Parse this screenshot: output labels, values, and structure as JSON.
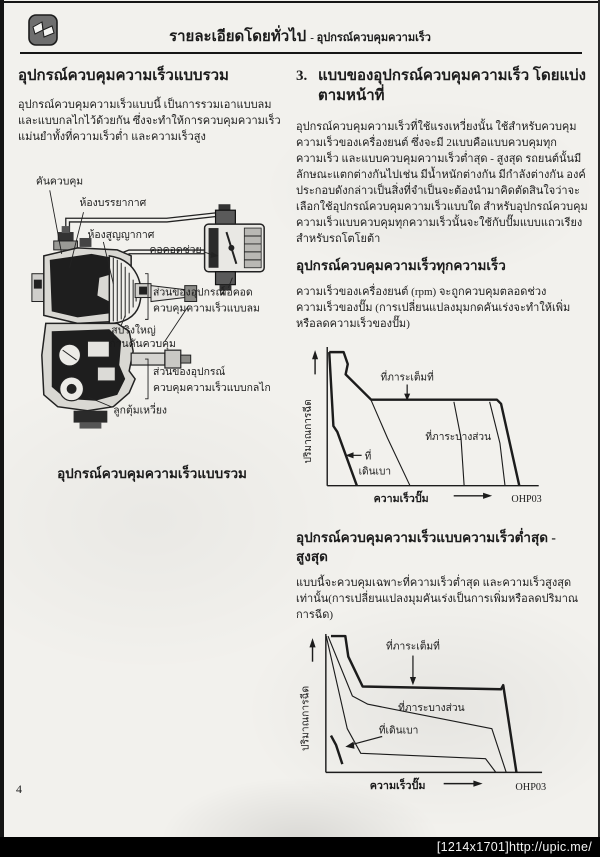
{
  "header": {
    "title_main": "รายละเอียดโดยทั่วไป",
    "title_sub": "- อุปกรณ์ควบคุมความเร็ว"
  },
  "left_column": {
    "heading": "อุปกรณ์ควบคุมความเร็วแบบรวม",
    "paragraph": "อุปกรณ์ควบคุมความเร็วแบบนี้ เป็นการรวมเอาแบบลม และแบบกลไกไว้ด้วยกัน ซึ่งจะทำให้การควบคุมความเร็วแม่นยำทั้งที่ความเร็วต่ำ และความเร็วสูง",
    "diagram": {
      "labels": {
        "control_lever": "คันควบคุม",
        "atmosphere_chamber": "ห้องบรรยากาศ",
        "vacuum_chamber": "ห้องสูญญากาศ",
        "aux_venturi": "คอคอดช่วย",
        "venturi": "คอคอด",
        "pneumatic_section_1": "ส่วนของอุปกรณ์",
        "pneumatic_section_2": "ควบคุมความเร็วแบบลม",
        "big_spring": "สปริงใหญ่",
        "control_rod": "ก้านคันควบคุม",
        "mechanical_section_1": "ส่วนของอุปกรณ์",
        "mechanical_section_2": "ควบคุมความเร็วแบบกลไก",
        "flyweight": "ลูกตุ้มเหวี่ยง"
      },
      "caption": "อุปกรณ์ควบคุมความเร็วแบบรวม"
    }
  },
  "right_column": {
    "section3_number": "3.",
    "section3_heading": "แบบของอุปกรณ์ควบคุมความเร็ว โดยแบ่งตามหน้าที่",
    "paragraph1": "อุปกรณ์ควบคุมความเร็วที่ใช้แรงเหวี่ยงนั้น ใช้สำหรับควบคุมความเร็วของเครื่องยนต์ ซึ่งจะมี 2แบบคือแบบควบคุมทุกความเร็ว และแบบควบคุมความเร็วต่ำสุด - สูงสุด รถยนต์นั้นมีลักษณะแตกต่างกันไปเช่น มีน้ำหนักต่างกัน มีกำลังต่างกัน องค์ประกอบดังกล่าวเป็นสิ่งที่จำเป็นจะต้องนำมาคิดตัดสินใจว่าจะเลือกใช้อุปกรณ์ควบคุมความเร็วแบบใด สำหรับอุปกรณ์ควบคุมความเร็วแบบควบคุมทุกความเร็วนั้นจะใช้กับปั๊มแบบแถวเรียงสำหรับรถโตโยต้า",
    "subheading1": "อุปกรณ์ควบคุมความเร็วทุกความเร็ว",
    "paragraph2": "ความเร็วของเครื่องยนต์ (rpm) จะถูกควบคุมตลอดช่วงความเร็วของปั๊ม (การเปลี่ยนแปลงมุมกดคันเร่งจะทำให้เพิ่มหรือลดความเร็วของปั๊ม)",
    "subheading2": "อุปกรณ์ควบคุมความเร็วแบบความเร็วต่ำสุด - สูงสุด",
    "paragraph3": "แบบนี้จะควบคุมเฉพาะที่ความเร็วต่ำสุด และความเร็วสูงสุดเท่านั้น(การเปลี่ยนแปลงมุมคันเร่งเป็นการเพิ่มหรือลดปริมาณการฉีด)"
  },
  "chart_data": [
    {
      "type": "line",
      "title": "อุปกรณ์ควบคุมความเร็วทุกความเร็ว (governor performance curves)",
      "xlabel": "ความเร็วปั๊ม",
      "ylabel": "ปริมาณการฉีด",
      "code": "OHP03",
      "axis_numeric": false,
      "annotations": {
        "full_load": "ที่ภาระเต็มที่",
        "partial_load": "ที่ภาระบางส่วน",
        "idle_1": "ที่",
        "idle_2": "เดินเบา"
      },
      "series": [
        {
          "name": "full-load-envelope",
          "emph": true,
          "points_pct": [
            [
              0.5,
              98.5
            ],
            [
              7.4,
              98.5
            ],
            [
              9.4,
              89.6
            ],
            [
              8.4,
              82.1
            ],
            [
              20.7,
              63.4
            ],
            [
              81.3,
              63.4
            ],
            [
              83.3,
              60.4
            ],
            [
              92.1,
              0
            ]
          ]
        },
        {
          "name": "idle-governing-line",
          "emph": true,
          "points_pct": [
            [
              0.5,
              98.5
            ],
            [
              2.5,
              44.0
            ],
            [
              4.4,
              39.6
            ],
            [
              13.8,
              0
            ]
          ]
        },
        {
          "name": "partial-load-1",
          "emph": false,
          "points_pct": [
            [
              20.7,
              63.0
            ],
            [
              28.6,
              35.1
            ],
            [
              39.4,
              0
            ]
          ]
        },
        {
          "name": "partial-load-2",
          "emph": false,
          "points_pct": [
            [
              60.6,
              61.9
            ],
            [
              64.0,
              35.1
            ],
            [
              65.5,
              0
            ]
          ]
        },
        {
          "name": "partial-load-3",
          "emph": false,
          "points_pct": [
            [
              77.8,
              61.9
            ],
            [
              82.8,
              31.3
            ],
            [
              85.2,
              0
            ]
          ]
        }
      ]
    },
    {
      "type": "line",
      "title": "อุปกรณ์ควบคุมความเร็วแบบความเร็วต่ำสุด - สูงสุด (governor performance curves)",
      "xlabel": "ความเร็วปั๊ม",
      "ylabel": "ปริมาณการฉีด",
      "code": "OHP03",
      "axis_numeric": false,
      "annotations": {
        "full_load": "ที่ภาระเต็มที่",
        "partial_load": "ที่ภาระบางส่วน",
        "idle": "ที่เดินเบา"
      },
      "series": [
        {
          "name": "full-load-curve",
          "emph": true,
          "points_pct": [
            [
              2.4,
              100
            ],
            [
              9.1,
              100
            ],
            [
              10.5,
              85
            ],
            [
              17.2,
              63
            ],
            [
              81.8,
              61
            ],
            [
              82.8,
              64
            ],
            [
              89.0,
              0
            ]
          ]
        },
        {
          "name": "partial-load-curve",
          "emph": false,
          "points_pct": [
            [
              1.0,
              100
            ],
            [
              12.4,
              56
            ],
            [
              19.6,
              50
            ],
            [
              77.5,
              32
            ],
            [
              84.2,
              0
            ]
          ]
        },
        {
          "name": "low-load-curve",
          "emph": false,
          "points_pct": [
            [
              0.2,
              100
            ],
            [
              10.0,
              32
            ],
            [
              16.3,
              14
            ],
            [
              74.6,
              10
            ],
            [
              79.4,
              0
            ]
          ]
        },
        {
          "name": "idle-line",
          "emph": true,
          "points_pct": [
            [
              2.4,
              27
            ],
            [
              4.8,
              20
            ],
            [
              7.7,
              6
            ]
          ]
        }
      ]
    }
  ],
  "footer": {
    "page_number": "4",
    "watermark": "[1214x1701]http://upic.me/"
  }
}
